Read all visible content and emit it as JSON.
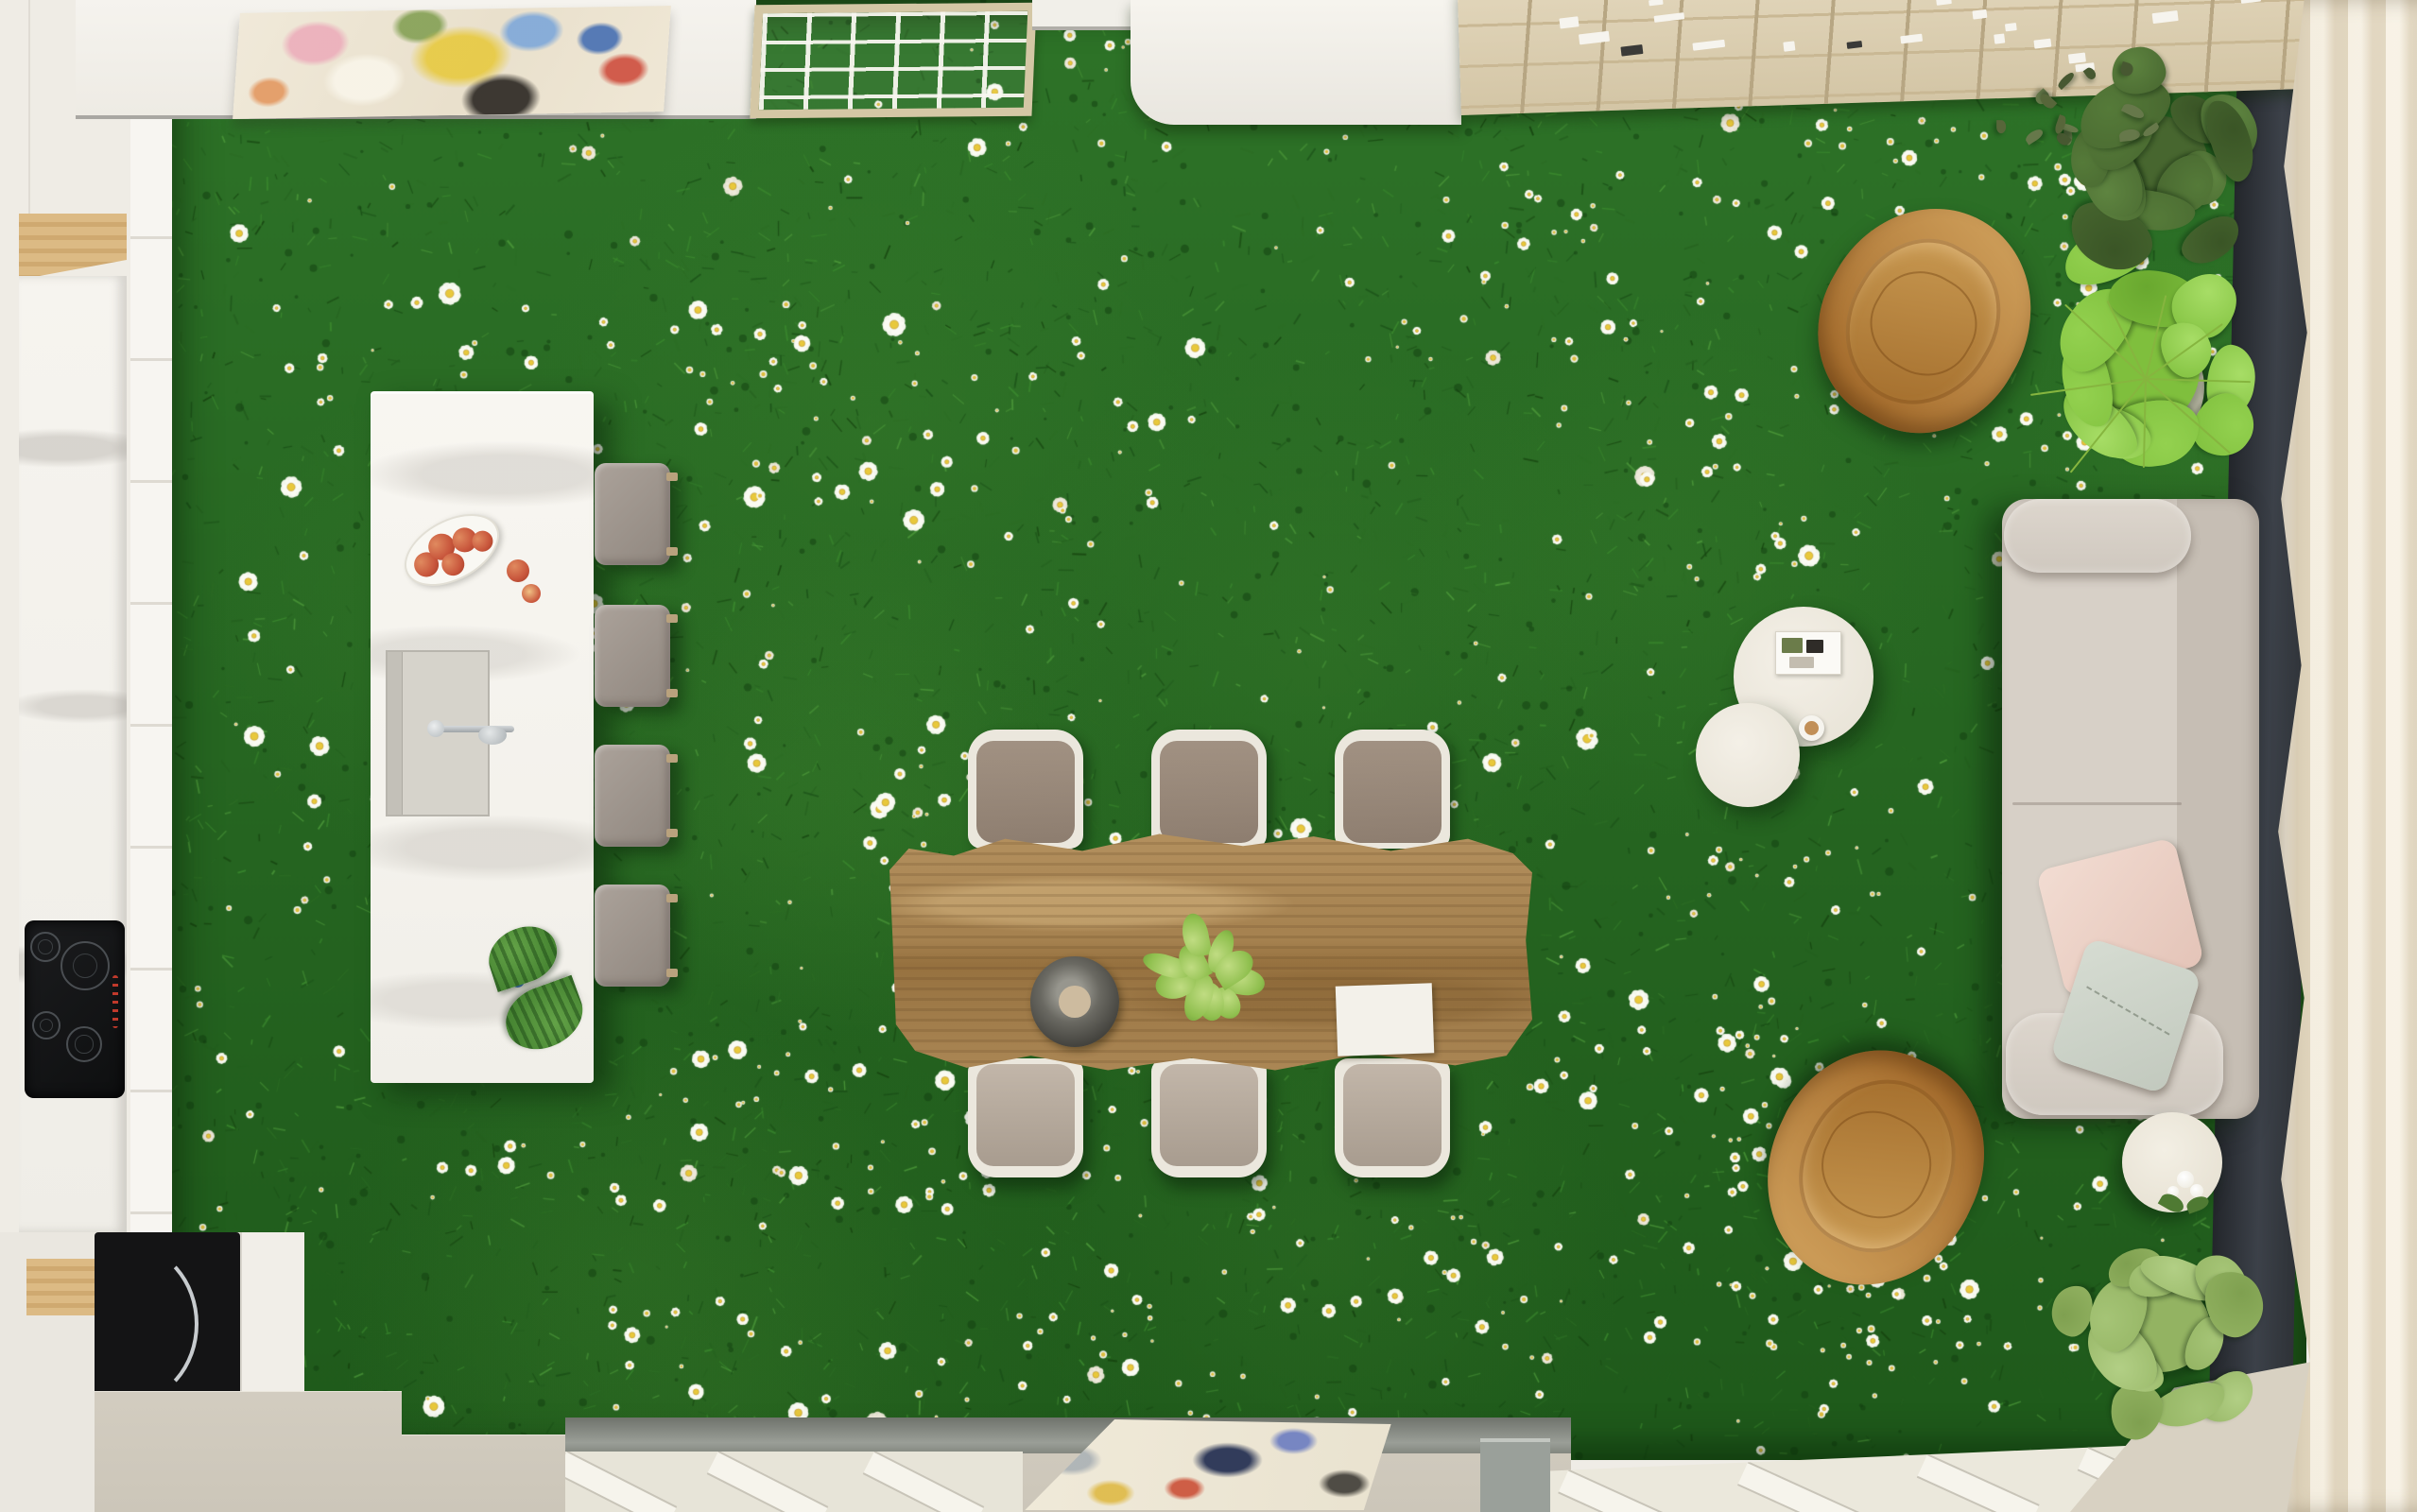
{
  "magazine": {
    "title": "MALDITO"
  },
  "palette": {
    "grass_green": "#2a6b24",
    "daisy_white": "#f7f8f2",
    "daisy_center": "#e4c23c",
    "table_wood": "#a8854f",
    "island_marble": "#f6f4ef",
    "stool_gray": "#a19890",
    "sofa_beige": "#d3ccc3",
    "leather_tan": "#b97f3f",
    "curtain_cream": "#ece2cf",
    "dark_panel": "#2e3237",
    "floor_greige": "#d0cabd"
  }
}
